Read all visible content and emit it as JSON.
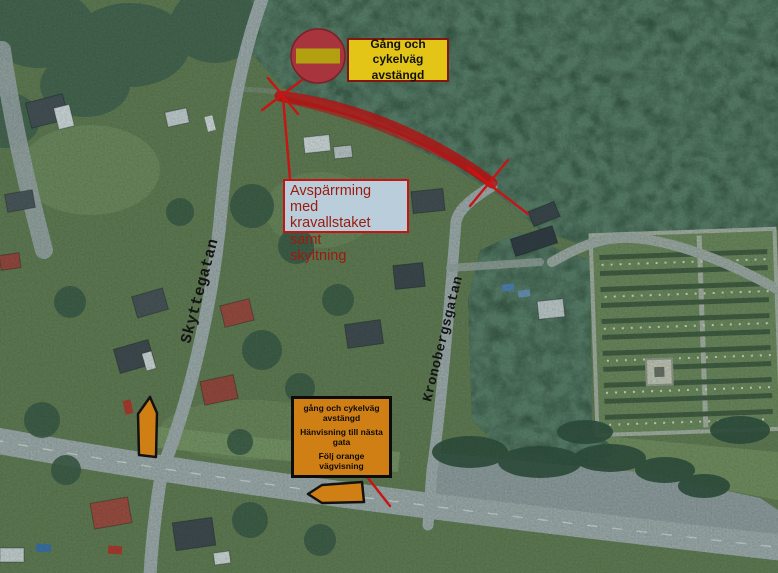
{
  "map": {
    "streets": {
      "west": "Skyttegatan",
      "east": "Kronobergsgatan"
    }
  },
  "annotations": {
    "sign_label": {
      "line1": "Gång och cykelväg",
      "line2": "avstängd"
    },
    "barrier_note": {
      "line1": "Avspärrming med",
      "line2": "kravallstaket samt",
      "line3": "skyltning"
    },
    "detour_box": {
      "line1": "gång och cykelväg avstängd",
      "line2": "Hänvisning till nästa gata",
      "line3": "Följ orange vägvisning"
    }
  },
  "icons": {
    "no_entry_sign": "no-entry-road-sign"
  },
  "colors": {
    "closure_red": "#b01212",
    "thin_red": "#c81414",
    "sign_circle_red": "#a8353d",
    "sign_bar_yellow": "#b3a011",
    "label_yellow_bg": "#e3c517",
    "label_yellow_border": "#7e1812",
    "barrier_box_bg": "#b9cdda",
    "barrier_box_border": "#c41414",
    "barrier_text_red": "#9c1a10",
    "detour_orange": "#d07f15",
    "forest_green": "#2c4634",
    "residential_green": "#63794f",
    "cemetery_green": "#6e8759",
    "road_gray": "#a4acad",
    "street_label_color": "#141414"
  }
}
